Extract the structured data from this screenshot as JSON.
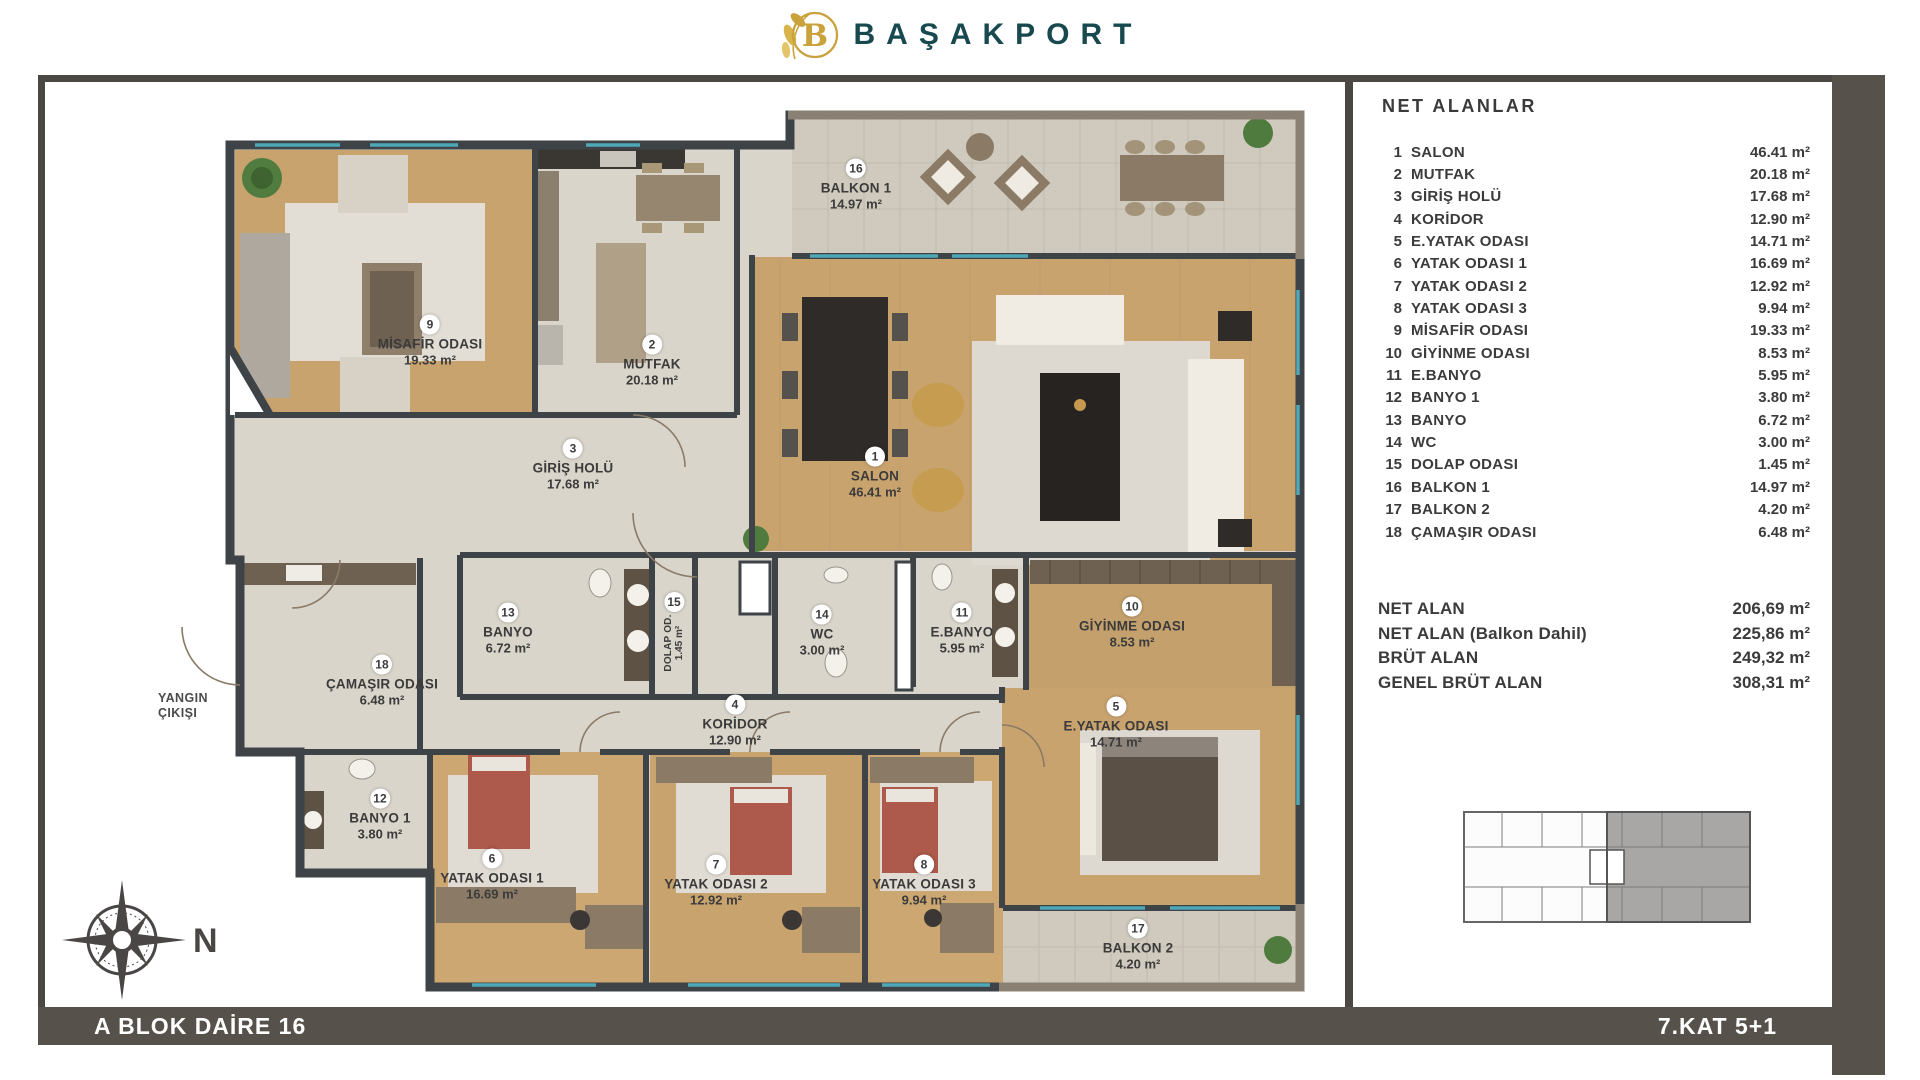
{
  "brand": {
    "name": "BAŞAKPORT",
    "logo_letter": "B"
  },
  "areas_panel": {
    "title": "NET ALANLAR",
    "rows": [
      {
        "num": "1",
        "label": "SALON",
        "value": "46.41 m²"
      },
      {
        "num": "2",
        "label": "MUTFAK",
        "value": "20.18 m²"
      },
      {
        "num": "3",
        "label": "GİRİŞ HOLÜ",
        "value": "17.68 m²"
      },
      {
        "num": "4",
        "label": "KORİDOR",
        "value": "12.90 m²"
      },
      {
        "num": "5",
        "label": "E.YATAK ODASI",
        "value": "14.71 m²"
      },
      {
        "num": "6",
        "label": "YATAK ODASI 1",
        "value": "16.69 m²"
      },
      {
        "num": "7",
        "label": "YATAK ODASI 2",
        "value": "12.92 m²"
      },
      {
        "num": "8",
        "label": "YATAK ODASI 3",
        "value": "9.94 m²"
      },
      {
        "num": "9",
        "label": "MİSAFİR ODASI",
        "value": "19.33 m²"
      },
      {
        "num": "10",
        "label": "GİYİNME ODASI",
        "value": "8.53 m²"
      },
      {
        "num": "11",
        "label": "E.BANYO",
        "value": "5.95 m²"
      },
      {
        "num": "12",
        "label": "BANYO 1",
        "value": "3.80 m²"
      },
      {
        "num": "13",
        "label": "BANYO",
        "value": "6.72 m²"
      },
      {
        "num": "14",
        "label": "WC",
        "value": "3.00 m²"
      },
      {
        "num": "15",
        "label": "DOLAP ODASI",
        "value": "1.45 m²"
      },
      {
        "num": "16",
        "label": "BALKON 1",
        "value": "14.97 m²"
      },
      {
        "num": "17",
        "label": "BALKON 2",
        "value": "4.20 m²"
      },
      {
        "num": "18",
        "label": "ÇAMAŞIR ODASI",
        "value": "6.48 m²"
      }
    ],
    "summary": [
      {
        "label": "NET ALAN",
        "value": "206,69 m²"
      },
      {
        "label": "NET ALAN (Balkon Dahil)",
        "value": "225,86 m²"
      },
      {
        "label": "BRÜT ALAN",
        "value": "249,32 m²"
      },
      {
        "label": "GENEL BRÜT ALAN",
        "value": "308,31 m²"
      }
    ]
  },
  "plan": {
    "fire_exit_line1": "YANGIN",
    "fire_exit_line2": "ÇIKIŞI",
    "compass_north": "N",
    "rooms": [
      {
        "num": "1",
        "name": "SALON",
        "area": "46.41 m²"
      },
      {
        "num": "2",
        "name": "MUTFAK",
        "area": "20.18 m²"
      },
      {
        "num": "3",
        "name": "GİRİŞ HOLÜ",
        "area": "17.68 m²"
      },
      {
        "num": "4",
        "name": "KORİDOR",
        "area": "12.90 m²"
      },
      {
        "num": "5",
        "name": "E.YATAK ODASI",
        "area": "14.71 m²"
      },
      {
        "num": "6",
        "name": "YATAK ODASI 1",
        "area": "16.69 m²"
      },
      {
        "num": "7",
        "name": "YATAK ODASI 2",
        "area": "12.92 m²"
      },
      {
        "num": "8",
        "name": "YATAK ODASI 3",
        "area": "9.94 m²"
      },
      {
        "num": "9",
        "name": "MİSAFİR ODASI",
        "area": "19.33 m²"
      },
      {
        "num": "10",
        "name": "GİYİNME ODASI",
        "area": "8.53 m²"
      },
      {
        "num": "11",
        "name": "E.BANYO",
        "area": "5.95 m²"
      },
      {
        "num": "12",
        "name": "BANYO 1",
        "area": "3.80 m²"
      },
      {
        "num": "13",
        "name": "BANYO",
        "area": "6.72 m²"
      },
      {
        "num": "14",
        "name": "WC",
        "area": "3.00 m²"
      },
      {
        "num": "15",
        "name": "DOLAP OD.",
        "area": "1.45 m²"
      },
      {
        "num": "16",
        "name": "BALKON 1",
        "area": "14.97 m²"
      },
      {
        "num": "17",
        "name": "BALKON 2",
        "area": "4.20 m²"
      },
      {
        "num": "18",
        "name": "ÇAMAŞIR ODASI",
        "area": "6.48 m²"
      }
    ]
  },
  "footer": {
    "left": "A BLOK DAİRE 16",
    "right": "7.KAT 5+1"
  },
  "colors": {
    "brand_teal": "#17494f",
    "gold": "#c9a23b",
    "frame": "#4b4742",
    "bar": "#56524b",
    "wall": "#3e4348",
    "wood": "#c9a36e",
    "tile": "#dad5cb",
    "balcony": "#cfcabd",
    "window": "#4fa8b8",
    "bed_red": "#ad594b"
  }
}
